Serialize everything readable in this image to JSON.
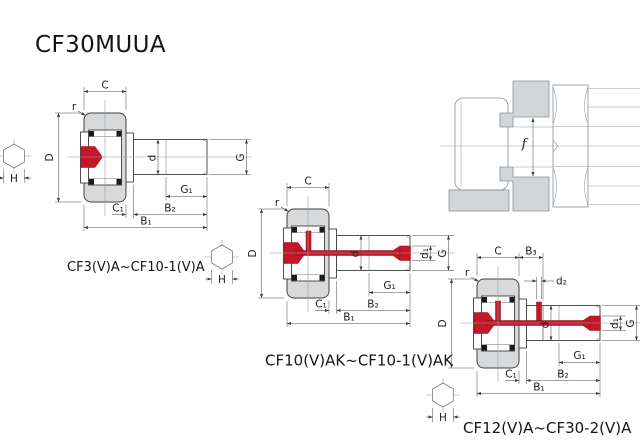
{
  "title": "CF30MUUA",
  "colors": {
    "accent_red": "#c4182a",
    "part_gray": "#d7d9da",
    "outline": "#3f3f3f",
    "centerline": "#9c9c9c"
  },
  "hex_icon": {
    "label": "H"
  },
  "mounting": {
    "label_f": "f"
  },
  "diagrams": {
    "d1": {
      "caption": "CF3(V)A~CF10-1(V)A",
      "labels": {
        "C": "C",
        "r": "r",
        "D": "D",
        "d": "d",
        "G": "G",
        "G1": "G₁",
        "C1": "C₁",
        "B2": "B₂",
        "B1": "B₁",
        "H": "H"
      }
    },
    "d2": {
      "caption": "CF10(V)AK~CF10-1(V)AK",
      "labels": {
        "C": "C",
        "r": "r",
        "D": "D",
        "d": "d",
        "d1": "d₁",
        "G": "G",
        "G1": "G₁",
        "C1": "C₁",
        "B2": "B₂",
        "B1": "B₁",
        "H": "H"
      }
    },
    "d3": {
      "caption": "CF12(V)A~CF30-2(V)A",
      "labels": {
        "C": "C",
        "B3": "B₃",
        "d2": "d₂",
        "r": "r",
        "D": "D",
        "d": "d",
        "d1": "d₁",
        "G": "G",
        "G1": "G₁",
        "C1": "C₁",
        "B2": "B₂",
        "B1": "B₁",
        "H": "H"
      }
    }
  }
}
